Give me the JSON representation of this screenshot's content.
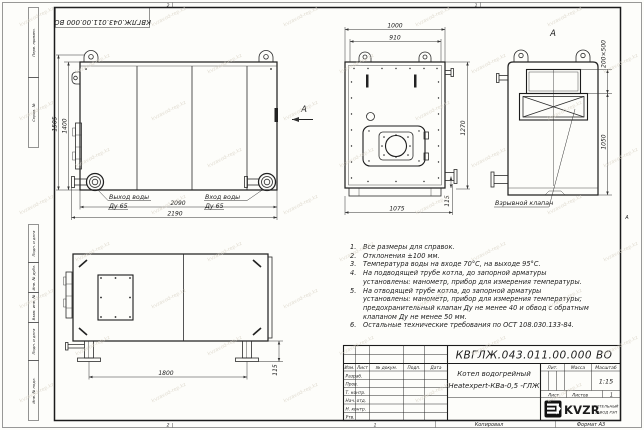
{
  "stamp": {
    "doc_number_rotated": "КВГЛЖ.043.011.00.000 ВО"
  },
  "frame": {
    "left_labels": [
      "Перв. примен.",
      "Справ. №",
      "Подп. и дата",
      "Инв. № дубл.",
      "Взам. инв. №",
      "Подп. и дата",
      "Инв. № подл."
    ],
    "zone_top_left": "2",
    "zone_top_right": "1",
    "zone_bottom_left": "2",
    "zone_bottom_right": "1",
    "zone_right_letter": "А"
  },
  "views": {
    "side": {
      "dim_overall_height": "1505",
      "dim_body_height": "1400",
      "dim_body_length": "2090",
      "dim_overall_length": "2190",
      "outlet_label": "Выход воды",
      "outlet_dn": "Ду 65",
      "inlet_label": "Вход воды",
      "inlet_dn": "Ду 65",
      "view_arrow_label": "А"
    },
    "front": {
      "dim_width_overall": "1000",
      "dim_width_body": "910",
      "dim_height": "1270",
      "dim_foot": "115",
      "dim_depth": "1075"
    },
    "rear": {
      "view_label": "А",
      "dim_valve_opening": "200×500",
      "dim_height": "1050",
      "callout_explosion_valve": "Взрывной клапан"
    },
    "bottom_view": {
      "dim_leg_span": "1800",
      "dim_leg_height": "115"
    }
  },
  "notes": {
    "items": [
      {
        "n": "1.",
        "text": "Все размеры для справок."
      },
      {
        "n": "2.",
        "text": "Отклонения ±100 мм."
      },
      {
        "n": "3.",
        "text": "Температура воды на входе 70°С, на выходе 95°С."
      },
      {
        "n": "4.",
        "text": "На подводящей трубе котла, до запорной арматуры установлены: манометр, прибор для измерения температуры."
      },
      {
        "n": "5.",
        "text": "На отводящей трубе котла, до запорной арматуры установлены: манометр, прибор для измерения температуры; предохранительный клапан Ду не менее 40 и обвод с обратным клапаном Ду не менее 50 мм."
      },
      {
        "n": "6.",
        "text": "Остальные технические требования по ОСТ 108.030.133-84."
      }
    ]
  },
  "title_block": {
    "doc_number": "КВГЛЖ.043.011.00.000 ВО",
    "name_line1": "Котел водогрейный",
    "name_line2": "Heatexpert-КВа-0,5 -ГЛЖ",
    "cols": [
      "Изм.",
      "Лист",
      "№ докум.",
      "Подп.",
      "Дата"
    ],
    "rows": [
      "Разраб.",
      "Пров.",
      "Т. контр.",
      "Нач. отд.",
      "Н. контр.",
      "Утв."
    ],
    "lit_label": "Лит.",
    "mass_label": "Масса",
    "scale_label": "Масштаб",
    "scale_value": "1:15",
    "sheet_label": "Лист",
    "sheets_label": "Листов",
    "sheets_value": "1",
    "logo_text": "KVZR",
    "company_line1": "КОТЕЛЬНЫЙ",
    "company_line2": "ЗАВОД РЭП",
    "copied_label": "Копировал",
    "format_label": "Формат А3"
  },
  "watermark": "kvzavod-rep.kz",
  "colors": {
    "line": "#222222",
    "paper": "#fdfdfa",
    "watermark": "#d9d3c6"
  }
}
